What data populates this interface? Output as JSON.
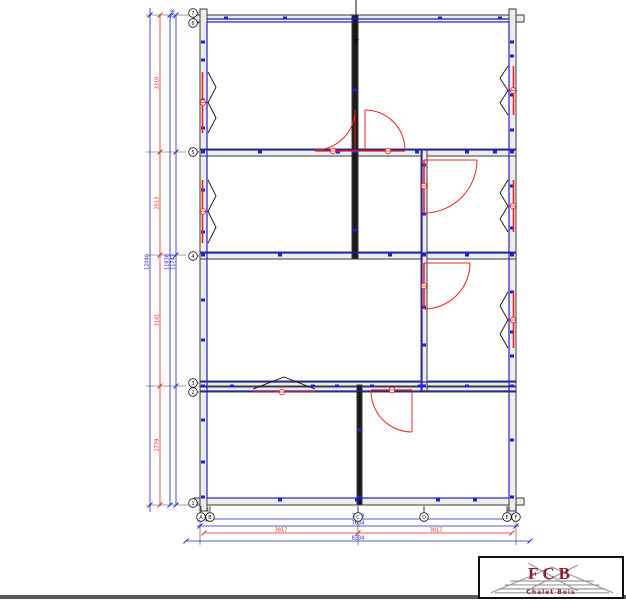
{
  "colors": {
    "blue": "#2020cc",
    "red": "#e82420",
    "wall_line": "#3a3a3a",
    "wall_fill": "#ededed",
    "wall_dark": "#1a1a1a",
    "black": "#111111",
    "logo_red": "#8e1f32",
    "truss_gray": "#9a9a9a",
    "bar_gray": "#58585a"
  },
  "logo": {
    "acronym": "FCB",
    "name": "Chalet Bois"
  },
  "floorplan": {
    "walls": [
      [
        194,
        15,
        330,
        7,
        "l"
      ],
      [
        194,
        498,
        330,
        7,
        "l"
      ],
      [
        200,
        9,
        7,
        502,
        "l"
      ],
      [
        509,
        9,
        7,
        502,
        "l"
      ],
      [
        200,
        149,
        316,
        7,
        "l"
      ],
      [
        200,
        252,
        316,
        7,
        "l"
      ],
      [
        200,
        381,
        316,
        5,
        "l"
      ],
      [
        200,
        387,
        316,
        5,
        "l"
      ],
      [
        352,
        15,
        6,
        244,
        "d"
      ],
      [
        357,
        385,
        5,
        120,
        "d"
      ],
      [
        421,
        149,
        6,
        243,
        "l"
      ]
    ],
    "blue_rect": [
      207,
      22,
      302,
      476
    ],
    "blue_lines": [
      [
        207,
        19,
        509,
        19
      ],
      [
        200,
        150,
        516,
        150
      ],
      [
        200,
        253,
        516,
        253
      ],
      [
        200,
        382,
        516,
        382
      ],
      [
        200,
        391,
        516,
        391
      ],
      [
        422,
        150,
        422,
        392
      ]
    ],
    "markers": [
      [
        226,
        18
      ],
      [
        285,
        18
      ],
      [
        356,
        18
      ],
      [
        440,
        18
      ],
      [
        500,
        18
      ],
      [
        203,
        42
      ],
      [
        203,
        60
      ],
      [
        203,
        100
      ],
      [
        203,
        128
      ],
      [
        203,
        152
      ],
      [
        203,
        190
      ],
      [
        203,
        232
      ],
      [
        203,
        255
      ],
      [
        203,
        300
      ],
      [
        203,
        340
      ],
      [
        203,
        386
      ],
      [
        203,
        420
      ],
      [
        203,
        462
      ],
      [
        203,
        497
      ],
      [
        512,
        42
      ],
      [
        512,
        56
      ],
      [
        512,
        95
      ],
      [
        512,
        130
      ],
      [
        512,
        152
      ],
      [
        512,
        186
      ],
      [
        512,
        228
      ],
      [
        512,
        255
      ],
      [
        512,
        292
      ],
      [
        512,
        332
      ],
      [
        512,
        356
      ],
      [
        512,
        386
      ],
      [
        512,
        440
      ],
      [
        512,
        497
      ],
      [
        355,
        90
      ],
      [
        355,
        152
      ],
      [
        355,
        230
      ],
      [
        359,
        430
      ],
      [
        359,
        497
      ],
      [
        424,
        165
      ],
      [
        424,
        214
      ],
      [
        424,
        255
      ],
      [
        424,
        307
      ],
      [
        424,
        345
      ],
      [
        424,
        386
      ],
      [
        260,
        152
      ],
      [
        338,
        152
      ],
      [
        417,
        152
      ],
      [
        467,
        152
      ],
      [
        495,
        152
      ],
      [
        280,
        255
      ],
      [
        390,
        255
      ],
      [
        467,
        255
      ],
      [
        232,
        386
      ],
      [
        313,
        386
      ],
      [
        337,
        386
      ],
      [
        372,
        386
      ],
      [
        420,
        386
      ],
      [
        467,
        386
      ],
      [
        280,
        500
      ],
      [
        357,
        500
      ],
      [
        438,
        500
      ],
      [
        475,
        500
      ]
    ],
    "windows": {
      "left": [
        [
          72,
          133
        ],
        [
          180,
          243
        ]
      ],
      "right": [
        [
          66,
          115
        ],
        [
          180,
          232
        ],
        [
          292,
          348
        ]
      ],
      "bottom": [
        [
          253,
          315,
          383
        ]
      ]
    },
    "doors": {
      "double": {
        "arcs": [
          "M315,150 A40,40 0 0 0 355,110",
          "M405,150 A40,40 0 0 0 365,110"
        ],
        "leaves": [
          [
            355,
            110,
            355,
            150
          ],
          [
            365,
            110,
            365,
            150
          ]
        ],
        "wall_line": [
          315,
          151,
          405,
          151
        ],
        "circles": [
          [
            333,
            151
          ],
          [
            388,
            151
          ]
        ]
      },
      "singles": [
        {
          "arc": "M477,160 A53,53 0 0 1 424,213",
          "leaf": [
            424,
            160,
            477,
            160
          ],
          "jamb": [
            424,
            160,
            424,
            213
          ],
          "circle": [
            424,
            186
          ]
        },
        {
          "arc": "M470,263 A46,46 0 0 1 424,309",
          "leaf": [
            424,
            263,
            470,
            263
          ],
          "jamb": [
            424,
            263,
            424,
            309
          ],
          "circle": [
            424,
            286
          ]
        },
        {
          "arc": "M371,391 A41,41 0 0 0 412,432",
          "leaf": [
            412,
            391,
            412,
            432
          ],
          "wall_line": [
            371,
            390,
            412,
            390
          ],
          "circle": [
            392,
            390
          ]
        }
      ]
    },
    "dims_v": [
      {
        "x": 150,
        "c": "b",
        "y1": 8,
        "y2": 512,
        "ticks": [
          15,
          505
        ],
        "labels": [
          [
            262,
            "12040"
          ]
        ]
      },
      {
        "x": 160,
        "c": "r",
        "y1": 15,
        "y2": 505,
        "ticks": [
          15,
          152,
          255,
          386,
          505
        ],
        "labels": [
          [
            83,
            "3310"
          ],
          [
            203,
            "2513"
          ],
          [
            320,
            "3141"
          ],
          [
            445,
            "2779"
          ]
        ]
      },
      {
        "x": 170,
        "c": "b",
        "y1": 15,
        "y2": 505,
        "ticks": [
          15,
          505
        ],
        "labels": [
          [
            262,
            "11838"
          ]
        ]
      },
      {
        "x": 176,
        "c": "b",
        "y1": 15,
        "y2": 505,
        "ticks": [
          15,
          152,
          255,
          386,
          505
        ],
        "labels": [
          [
            262,
            "11743"
          ],
          [
            14,
            "298"
          ]
        ]
      }
    ],
    "dims_h": [
      {
        "y": 519,
        "c": "b",
        "x1": 197,
        "x2": 519,
        "ticks": [
          200,
          208,
          358,
          508,
          516
        ],
        "labels": [
          [
            204,
            "298"
          ],
          [
            358,
            "7038"
          ],
          [
            512,
            "298"
          ]
        ]
      },
      {
        "y": 526,
        "c": "b",
        "x1": 197,
        "x2": 519,
        "ticks": [
          200,
          516
        ],
        "labels": [
          [
            358,
            "7634"
          ]
        ]
      },
      {
        "y": 533,
        "c": "r",
        "x1": 204,
        "x2": 512,
        "ticks": [
          204,
          358,
          512
        ],
        "labels": [
          [
            281,
            "3817"
          ],
          [
            436,
            "3817"
          ]
        ]
      },
      {
        "y": 541,
        "c": "b",
        "x1": 186,
        "x2": 530,
        "ticks": [
          186,
          530
        ],
        "labels": [
          [
            358,
            "8234"
          ]
        ]
      }
    ],
    "ext_v": [
      [
        200,
        507,
        200,
        545
      ],
      [
        358,
        507,
        358,
        545
      ],
      [
        516,
        507,
        516,
        545
      ],
      [
        424,
        507,
        424,
        522
      ],
      [
        508,
        507,
        508,
        522
      ],
      [
        208,
        507,
        208,
        522
      ]
    ],
    "ext_h": [
      [
        146,
        15,
        196,
        15
      ],
      [
        146,
        152,
        186,
        152
      ],
      [
        146,
        255,
        186,
        255
      ],
      [
        146,
        386,
        186,
        386
      ],
      [
        146,
        505,
        196,
        505
      ]
    ],
    "bubbles_bottom": [
      [
        "A",
        201
      ],
      [
        "B",
        210
      ],
      [
        "C",
        358
      ],
      [
        "D",
        424
      ],
      [
        "E",
        507
      ],
      [
        "F",
        516
      ]
    ],
    "bubbles_left": [
      [
        "7",
        13
      ],
      [
        "6",
        23
      ],
      [
        "5",
        152
      ],
      [
        "4",
        256
      ],
      [
        "3",
        383
      ],
      [
        "2",
        392
      ],
      [
        "1",
        503
      ]
    ],
    "section_line": {
      "x": 356,
      "y1": 0,
      "y2": 45
    }
  }
}
